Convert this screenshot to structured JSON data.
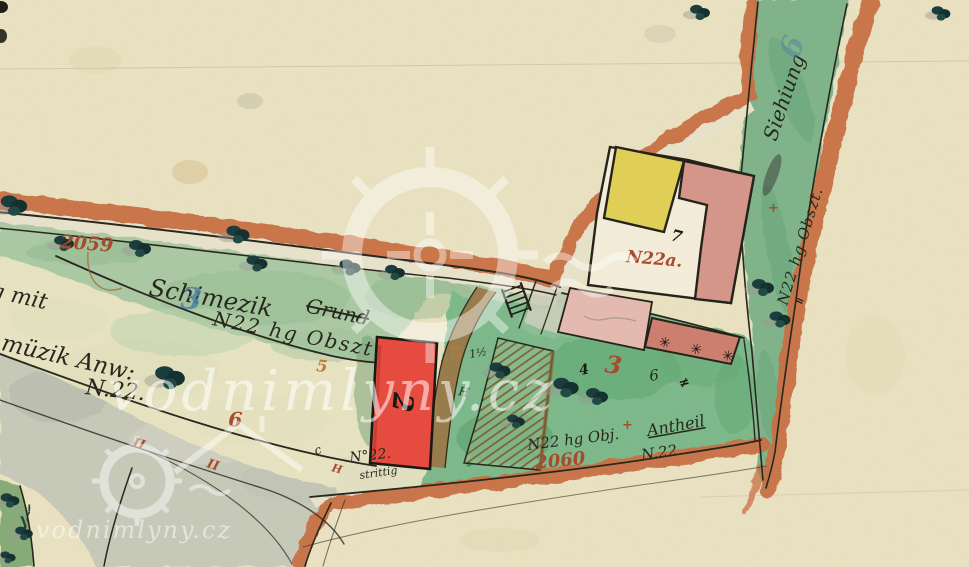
{
  "map_kind": "scanned hand-drawn historical cadastral map",
  "labels": {
    "parcel_2059": "2059",
    "meadow_class_blue": "3",
    "meadow_owner": "Schimezik",
    "meadow_owner_struck": "Grund",
    "meadow_ref": "N22 hg Obszt",
    "meadow_quality": "5",
    "dispute_line1": "ttig mit",
    "dispute_line2": "Schmüzik Anw:",
    "dispute_line3": "N.22.",
    "pale_class": "6",
    "mill_number": "2",
    "mill_note1": "N°22.",
    "mill_note2": "strittig",
    "house_number": "N22a.",
    "house_mark": "7",
    "garden_class_red": "3",
    "garden_ref": "N22 hg Obj.",
    "parcel_2060": "2060",
    "garden_share1": "Antheil",
    "garden_share2": "N.22",
    "road_name": "Siehiung",
    "road_ref": "N22 hg Obszt.",
    "road_class_blue": "6",
    "orchard_stars": "✳ ✳ ✳"
  },
  "marks": {
    "plus_red_strip": "+",
    "equals_strip": "=",
    "plus_red_garden": "+",
    "tick_ii_1": "II",
    "tick_ii_2": "II",
    "tick_h_red": "H",
    "tick_c": "c",
    "mark_four": "4",
    "mark_six": "6",
    "mark_hash": "≠",
    "mark_half": "1½",
    "mark_h_black": "H",
    "mark_orange_12": "12"
  },
  "watermark": {
    "text_large": "vodnimlyny.cz",
    "text_small": "vodnimlyny.cz"
  },
  "colors": {
    "parchment": "#ebe3c2",
    "road_border_orange": "#c96e42",
    "meadow_green": "#abcaa4",
    "garden_green": "#7cb98b",
    "strip_green": "#7fb48a",
    "river_grey": "#c6c8ba",
    "mill_red": "#e8483c",
    "house_pink": "#d6958a",
    "orchard_pink_dark": "#cd7d6e",
    "house_yellow": "#e2d055",
    "courtyard_white": "#f4eedb",
    "path_brown": "#9b7544",
    "ink_black": "#23231a",
    "number_red": "#a8462a",
    "number_blue": "#4e7fa3",
    "number_orange": "#bf7a35",
    "watermark_white": "#ffffff"
  }
}
